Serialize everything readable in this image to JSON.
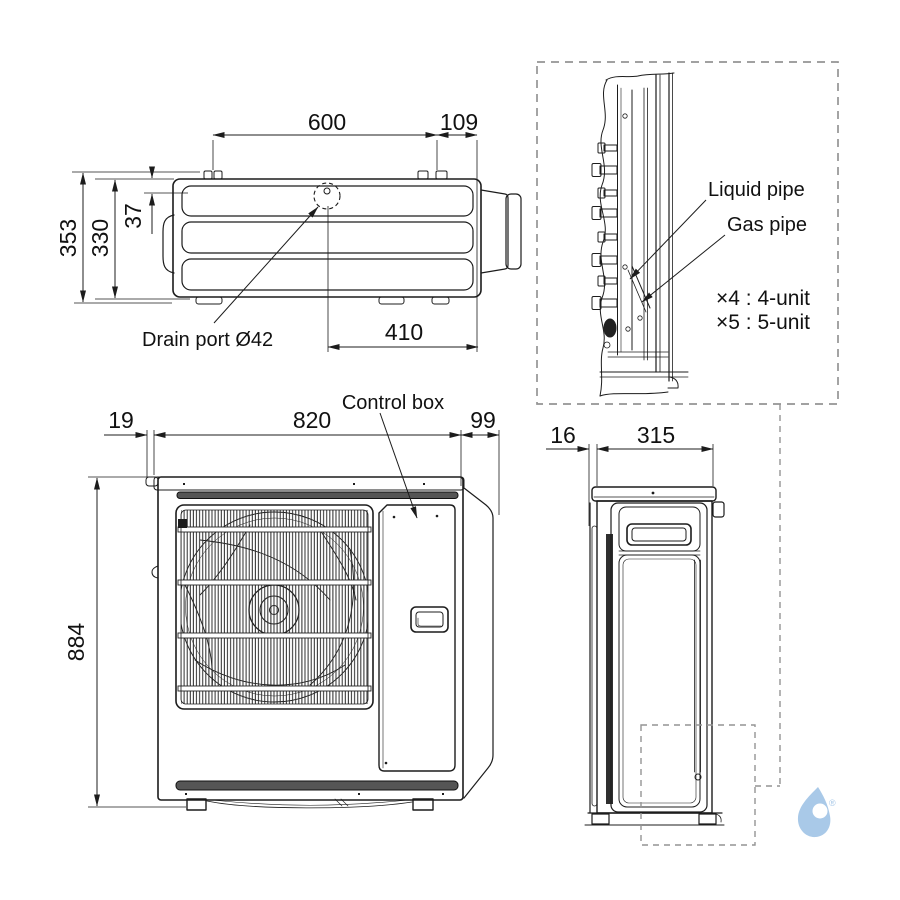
{
  "drawing": {
    "colors": {
      "line": "#1c1c1c",
      "dash_gray": "#949494",
      "background": "#ffffff",
      "slot_fill": "#555555",
      "logo_blue": "#a9c9e8"
    },
    "top_view": {
      "dim_width": "600",
      "dim_right": "109",
      "dim_depth_total": "353",
      "dim_depth_body": "330",
      "dim_drain": "37",
      "dim_drain_from_right": "410",
      "drain_label": "Drain port Ø42"
    },
    "piping_detail": {
      "liquid_label": "Liquid pipe",
      "gas_label": "Gas pipe",
      "note1": "×4 : 4-unit",
      "note2": "×5 : 5-unit"
    },
    "front_view": {
      "dim_left": "19",
      "dim_width": "820",
      "dim_right": "99",
      "dim_height": "884",
      "control_label": "Control box"
    },
    "side_view": {
      "dim_back": "16",
      "dim_depth": "315"
    },
    "logo": {
      "mark": "®"
    }
  }
}
